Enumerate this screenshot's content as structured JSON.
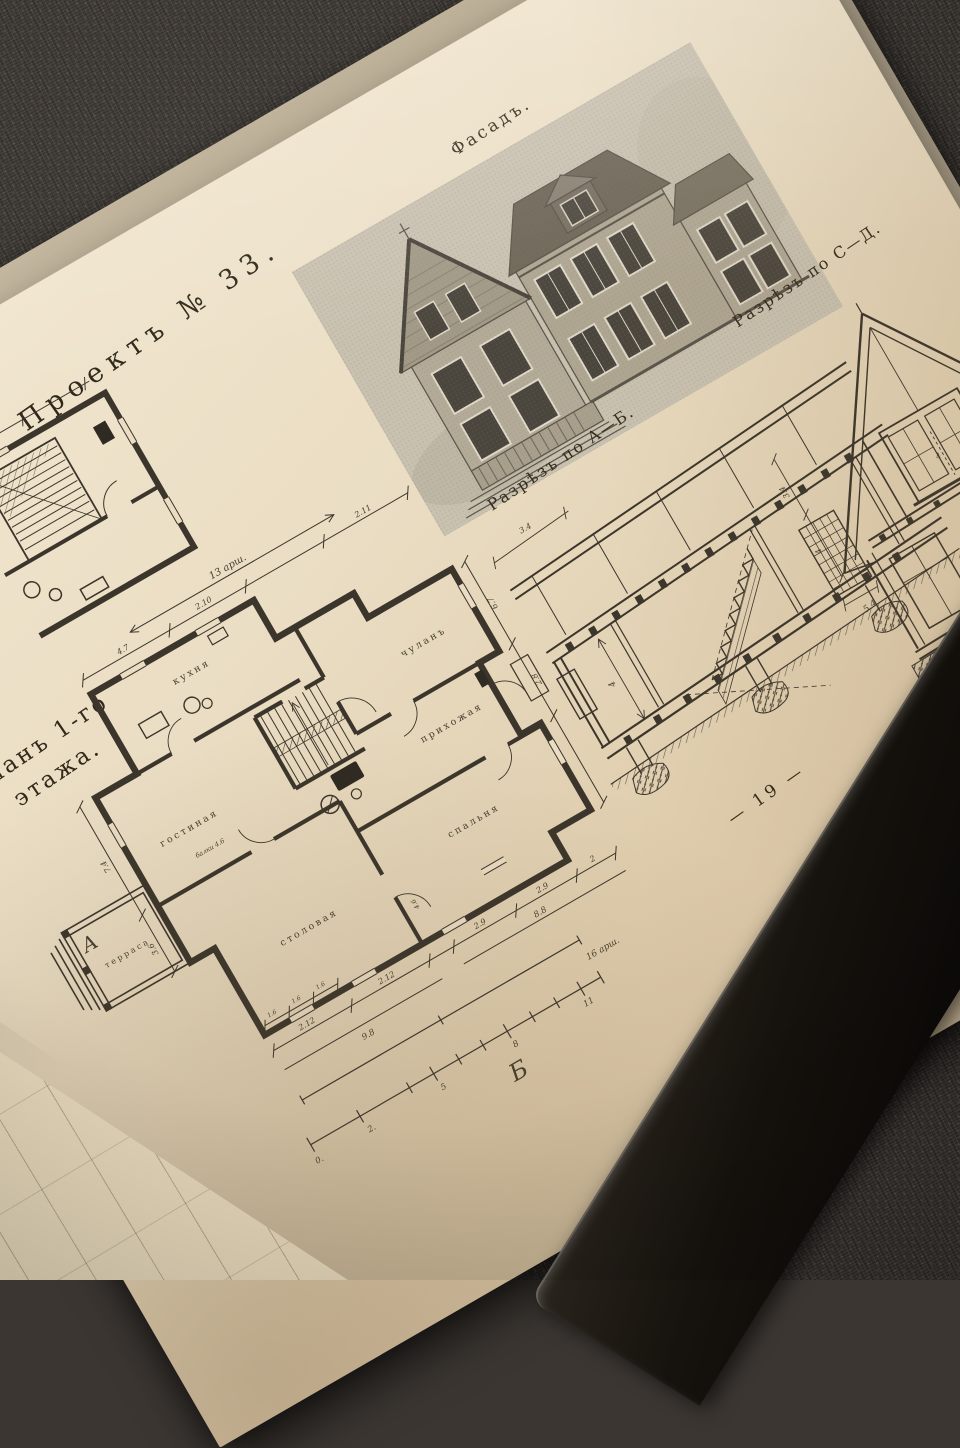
{
  "scene": {
    "carpet_color": "#3b3632",
    "book_cover_color": "#16120d",
    "page_color": "#eaddc3",
    "ink_color": "#3a342a"
  },
  "page": {
    "project_title": "Проектъ № 33.",
    "page_number": "— 19 —",
    "facade_label": "Фасадъ.",
    "section_ab_label": "Разрѣзъ по А—Б.",
    "section_cd_label": "Разрѣзъ по С—Д.",
    "plan_caption_line1": "Планъ 1-го",
    "plan_caption_line2": "этажа.",
    "rooms": {
      "kitchen": "кухня",
      "closet": "чуланъ",
      "hall": "прихожая",
      "bedroom": "спальня",
      "living_room": "гостиная",
      "dining_room": "столовая",
      "terrace": "терраса"
    },
    "markers": {
      "a": "А",
      "b": "Б"
    },
    "note_joists": "балки 4.6",
    "dims": {
      "overall_width": "13 арш.",
      "overall_length": "16 арш.",
      "top_1": "4.7",
      "top_2": "2.10",
      "top_3": "2.11",
      "right_1": "6.7",
      "right_2": "2.8",
      "bottom_1": "2.9",
      "bottom_2": "2.9",
      "bottom_3": "2",
      "bottom_4": "8.8",
      "bottom_5": "2.12",
      "bottom_6": "2.12",
      "bottom_7": "9.8",
      "left_1": "7.4",
      "left_2": "3.6",
      "inner_1": "1.6",
      "inner_2": "1.6",
      "inner_3": "1.6",
      "stair_width": "4.6",
      "scale_0": "0.",
      "scale_1": "2.",
      "scale_2": "5",
      "scale_3": "8",
      "scale_4": "11",
      "ab_1": "4",
      "ab_2": "3.4",
      "cd_1": "3.4",
      "cd_2": "4",
      "cd_3": "5.4",
      "cd_4": "4"
    }
  }
}
